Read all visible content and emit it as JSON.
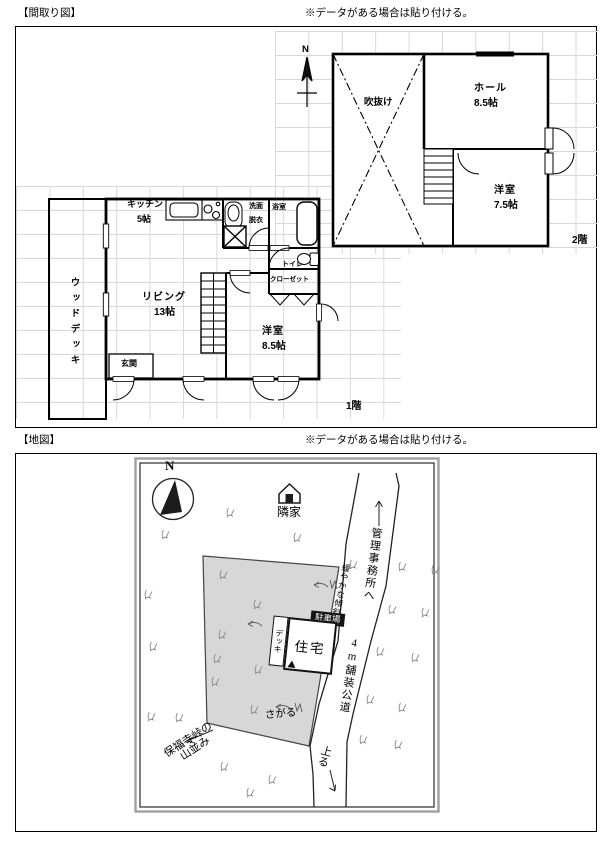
{
  "header": {
    "floorplan_title": "【間取り図】",
    "floorplan_note": "※データがある場合は貼り付ける。",
    "map_title": "【地図】",
    "map_note": "※データがある場合は貼り付ける。"
  },
  "floorplan": {
    "floor2": {
      "compass": "N",
      "void_label": "吹抜け",
      "hall_name": "ホール",
      "hall_size": "8.5帖",
      "room_name": "洋室",
      "room_size": "7.5帖",
      "floor_label": "2階"
    },
    "floor1": {
      "kitchen_name": "キッチン",
      "kitchen_size": "5帖",
      "washroom_line1": "洗面",
      "washroom_line2": "脱衣",
      "bath_label": "浴室",
      "toilet_label": "トイレ",
      "closet_label": "クローゼット",
      "living_name": "リビング",
      "living_size": "13帖",
      "room_name": "洋室",
      "room_size": "8.5帖",
      "entrance_label": "玄関",
      "wood_deck_label": "ウッドデッキ",
      "floor_label": "1階"
    }
  },
  "map": {
    "compass": "N",
    "neighbor_label": "隣家",
    "to_office_label": "管理事務所へ",
    "road_label": "4m舗装公道",
    "parking_label": "駐車場",
    "house_label": "住宅",
    "deck_label": "デッキ",
    "slope_label": "緩やかな傾斜",
    "down_label": "さがる",
    "up_label": "上る",
    "mountains_line1": "保福寺峠の",
    "mountains_line2": "山並み"
  },
  "colors": {
    "wall": "#000000",
    "grid": "#d8d8d8",
    "plot_fill": "#d7d7d7",
    "parking_bg": "#151515"
  }
}
